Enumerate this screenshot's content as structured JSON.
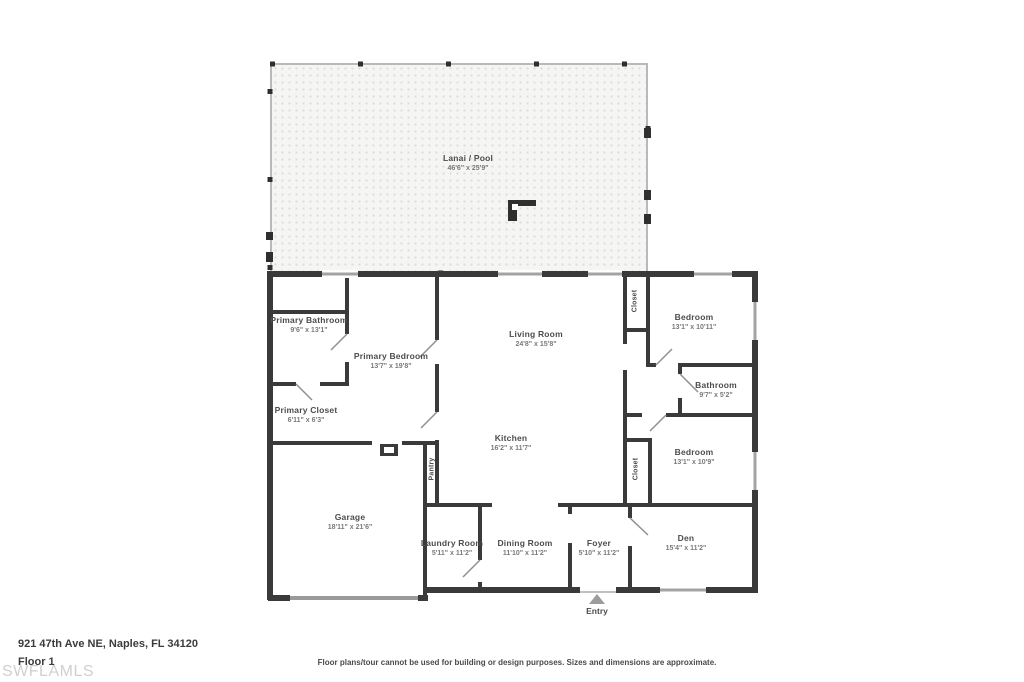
{
  "meta": {
    "address": "921 47th Ave NE, Naples, FL 34120",
    "floor_label": "Floor 1",
    "watermark": "SWFLAMLS",
    "disclaimer": "Floor plans/tour cannot be used for building or design purposes. Sizes and dimensions are approximate.",
    "entry_label": "Entry"
  },
  "colors": {
    "wall": "#3a3a3a",
    "window": "#a3a3a3",
    "lanai_dot": "#dcdcdc",
    "lanai_rail": "#b9b9b9",
    "entry_arrow": "#9c9c9c",
    "watermark": "#d0d0d0"
  },
  "rooms": {
    "lanai": {
      "name": "Lanai / Pool",
      "dims": "46'6\" x 25'9\""
    },
    "primary_bathroom": {
      "name": "Primary Bathroom",
      "dims": "9'6\" x 13'1\""
    },
    "primary_bedroom": {
      "name": "Primary Bedroom",
      "dims": "13'7\" x 19'8\""
    },
    "primary_closet": {
      "name": "Primary Closet",
      "dims": "6'11\" x 6'3\""
    },
    "living_room": {
      "name": "Living Room",
      "dims": "24'8\" x 15'8\""
    },
    "kitchen": {
      "name": "Kitchen",
      "dims": "16'2\" x 11'7\""
    },
    "pantry": {
      "name": "Pantry"
    },
    "garage": {
      "name": "Garage",
      "dims": "18'11\" x 21'6\""
    },
    "laundry_room": {
      "name": "Laundry Room",
      "dims": "5'11\" x 11'2\""
    },
    "dining_room": {
      "name": "Dining Room",
      "dims": "11'10\" x 11'2\""
    },
    "foyer": {
      "name": "Foyer",
      "dims": "5'10\" x 11'2\""
    },
    "den": {
      "name": "Den",
      "dims": "15'4\" x 11'2\""
    },
    "bedroom_top": {
      "name": "Bedroom",
      "dims": "13'1\" x 10'11\""
    },
    "bathroom": {
      "name": "Bathroom",
      "dims": "9'7\" x 5'2\""
    },
    "bedroom_bottom": {
      "name": "Bedroom",
      "dims": "13'1\" x 10'9\""
    },
    "closet_top": {
      "name": "Closet"
    },
    "closet_bottom": {
      "name": "Closet"
    }
  }
}
